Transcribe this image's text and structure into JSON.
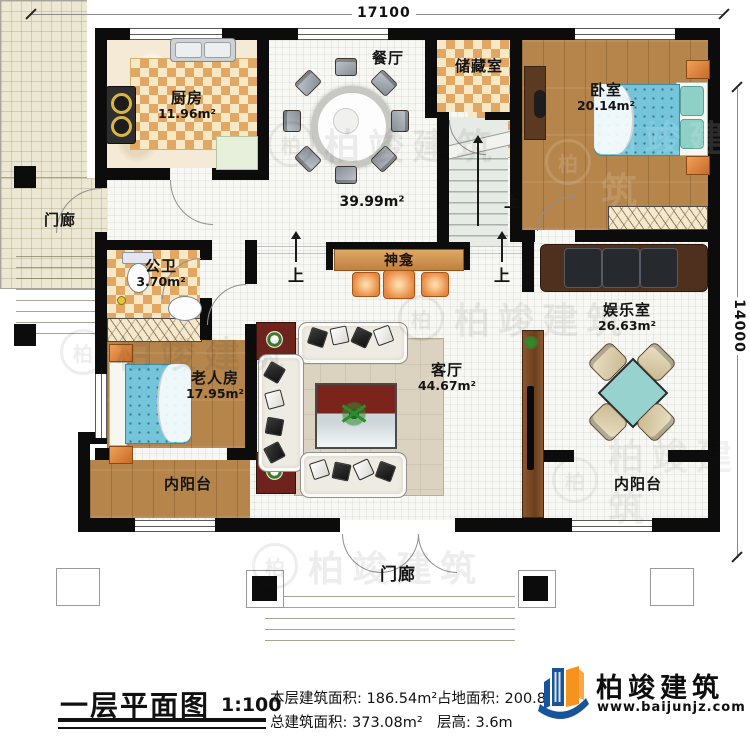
{
  "dims": {
    "top": "17100",
    "right": "14000"
  },
  "rooms": {
    "kitchen": {
      "name": "厨房",
      "area": "11.96m²"
    },
    "dining": {
      "name": "餐厅"
    },
    "storage": {
      "name": "储藏室"
    },
    "bedroom": {
      "name": "卧室",
      "area": "20.14m²"
    },
    "porch_left": {
      "name": "门廊"
    },
    "bath": {
      "name": "公卫",
      "area": "3.70m²"
    },
    "hall": {
      "area": "39.99m²"
    },
    "shrine": {
      "name": "神龛"
    },
    "elder": {
      "name": "老人房",
      "area": "17.95m²"
    },
    "living": {
      "name": "客厅",
      "area": "44.67m²"
    },
    "game": {
      "name": "娱乐室",
      "area": "26.63m²"
    },
    "balcony_left": {
      "name": "内阳台"
    },
    "balcony_right": {
      "name": "内阳台"
    },
    "porch_bottom": {
      "name": "门廊"
    }
  },
  "markers": {
    "up": "上"
  },
  "footer": {
    "title": "一层平面图",
    "scale": "1:100",
    "stats": [
      {
        "label": "本层建筑面积:",
        "value": "186.54m²"
      },
      {
        "label": "占地面积:",
        "value": "200.8"
      },
      {
        "label": "总建筑面积:",
        "value": "373.08m²"
      },
      {
        "label": "层高:",
        "value": "3.6m"
      }
    ],
    "brand": {
      "name": "柏竣建筑",
      "url": "www.baijunjz.com"
    }
  },
  "watermark": {
    "text": "柏竣建筑",
    "badge": "柏"
  }
}
